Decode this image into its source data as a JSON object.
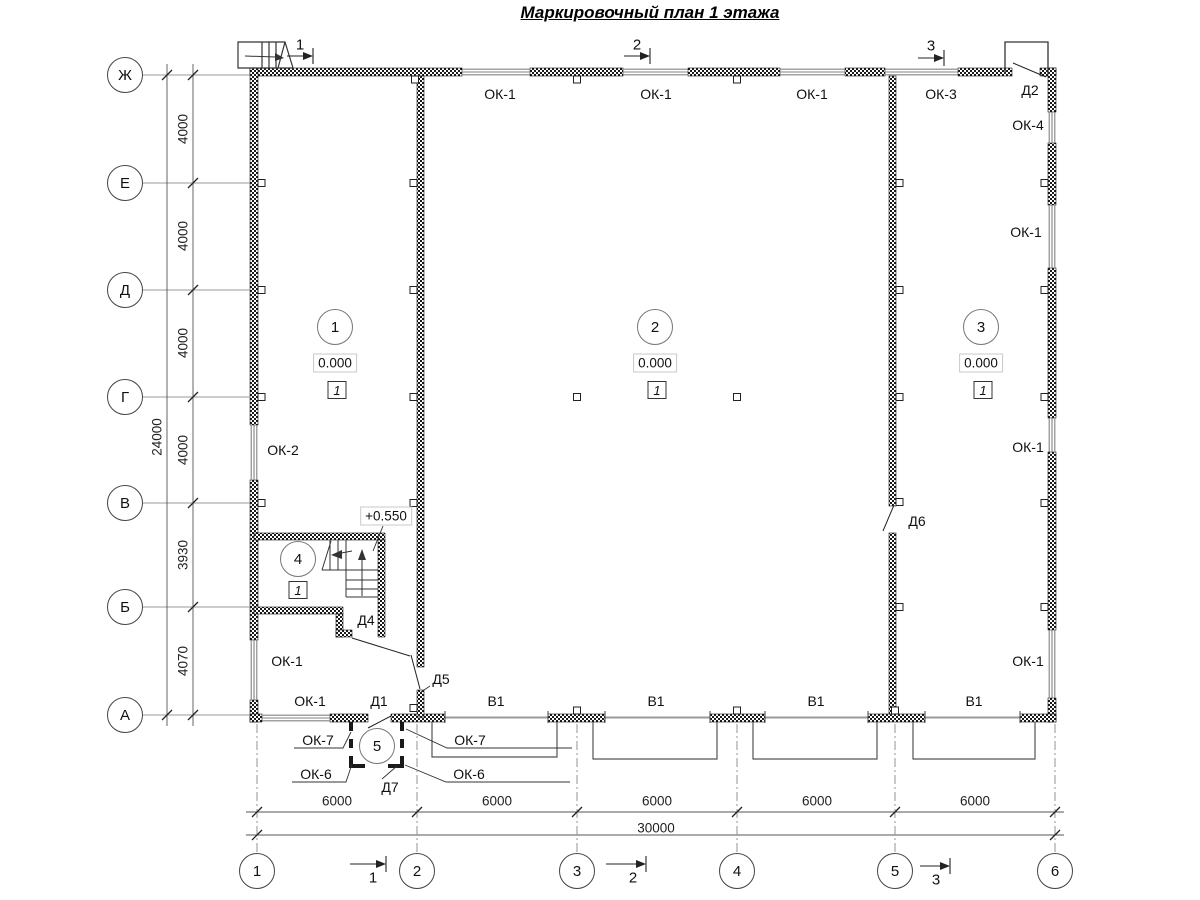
{
  "title": "Маркировочный план 1 этажа",
  "axes": {
    "rows": [
      {
        "label": "Ж",
        "y": 75
      },
      {
        "label": "Е",
        "y": 183
      },
      {
        "label": "Д",
        "y": 290
      },
      {
        "label": "Г",
        "y": 397
      },
      {
        "label": "В",
        "y": 503
      },
      {
        "label": "Б",
        "y": 607
      },
      {
        "label": "А",
        "y": 715
      }
    ],
    "cols": [
      {
        "label": "1",
        "x": 257
      },
      {
        "label": "2",
        "x": 417
      },
      {
        "label": "3",
        "x": 577
      },
      {
        "label": "4",
        "x": 737
      },
      {
        "label": "5",
        "x": 895
      },
      {
        "label": "6",
        "x": 1055
      }
    ]
  },
  "dimensions": {
    "left_segments": [
      {
        "text": "4000",
        "y": 129
      },
      {
        "text": "4000",
        "y": 236
      },
      {
        "text": "4000",
        "y": 343
      },
      {
        "text": "4000",
        "y": 450
      },
      {
        "text": "3930",
        "y": 555
      },
      {
        "text": "4070",
        "y": 661
      }
    ],
    "left_overall": {
      "text": "24000",
      "x": 157,
      "y": 437
    },
    "bottom_segments": [
      {
        "text": "6000",
        "x": 337
      },
      {
        "text": "6000",
        "x": 497
      },
      {
        "text": "6000",
        "x": 657
      },
      {
        "text": "6000",
        "x": 817
      },
      {
        "text": "6000",
        "x": 975
      }
    ],
    "bottom_overall": {
      "text": "30000",
      "x": 656,
      "y": 828
    }
  },
  "section_marks": {
    "top": [
      {
        "num": "1",
        "x": 300,
        "y": 45
      },
      {
        "num": "2",
        "x": 637,
        "y": 45
      },
      {
        "num": "3",
        "x": 931,
        "y": 46
      }
    ],
    "bottom": [
      {
        "num": "1",
        "x": 373,
        "y": 878
      },
      {
        "num": "2",
        "x": 633,
        "y": 878
      },
      {
        "num": "3",
        "x": 936,
        "y": 880
      }
    ]
  },
  "rooms": [
    {
      "num": "1",
      "cx": 335,
      "cy": 327,
      "elevation": "0.000",
      "type": "1"
    },
    {
      "num": "2",
      "cx": 655,
      "cy": 327,
      "elevation": "0.000",
      "type": "1"
    },
    {
      "num": "3",
      "cx": 981,
      "cy": 327,
      "elevation": "0.000",
      "type": "1"
    },
    {
      "num": "4",
      "cx": 298,
      "cy": 559,
      "elevation": null,
      "type": "1"
    },
    {
      "num": "5",
      "cx": 377,
      "cy": 746,
      "elevation": null,
      "type": null
    }
  ],
  "stair_elevation": "+0.550",
  "marks": [
    {
      "text": "ОК-1",
      "x": 500,
      "y": 94
    },
    {
      "text": "ОК-1",
      "x": 656,
      "y": 94
    },
    {
      "text": "ОК-1",
      "x": 812,
      "y": 94
    },
    {
      "text": "ОК-3",
      "x": 941,
      "y": 94
    },
    {
      "text": "Д2",
      "x": 1030,
      "y": 90
    },
    {
      "text": "ОК-4",
      "x": 1028,
      "y": 125
    },
    {
      "text": "ОК-1",
      "x": 1026,
      "y": 232
    },
    {
      "text": "ОК-2",
      "x": 283,
      "y": 450
    },
    {
      "text": "ОК-1",
      "x": 1028,
      "y": 447
    },
    {
      "text": "Д6",
      "x": 917,
      "y": 521
    },
    {
      "text": "ОК-1",
      "x": 287,
      "y": 661
    },
    {
      "text": "ОК-1",
      "x": 1028,
      "y": 661
    },
    {
      "text": "ОК-1",
      "x": 310,
      "y": 701
    },
    {
      "text": "Д1",
      "x": 379,
      "y": 701
    },
    {
      "text": "Д5",
      "x": 441,
      "y": 679
    },
    {
      "text": "В1",
      "x": 496,
      "y": 701
    },
    {
      "text": "В1",
      "x": 656,
      "y": 701
    },
    {
      "text": "В1",
      "x": 816,
      "y": 701
    },
    {
      "text": "В1",
      "x": 974,
      "y": 701
    },
    {
      "text": "Д4",
      "x": 366,
      "y": 620
    },
    {
      "text": "ОК-7",
      "x": 318,
      "y": 740
    },
    {
      "text": "ОК-6",
      "x": 316,
      "y": 774
    },
    {
      "text": "ОК-7",
      "x": 470,
      "y": 740
    },
    {
      "text": "ОК-6",
      "x": 469,
      "y": 774
    },
    {
      "text": "Д7",
      "x": 390,
      "y": 787
    }
  ],
  "colors": {
    "wall": "#1a1a1a",
    "window": "#828282",
    "dim_line": "#555555",
    "gate": "#999999"
  }
}
